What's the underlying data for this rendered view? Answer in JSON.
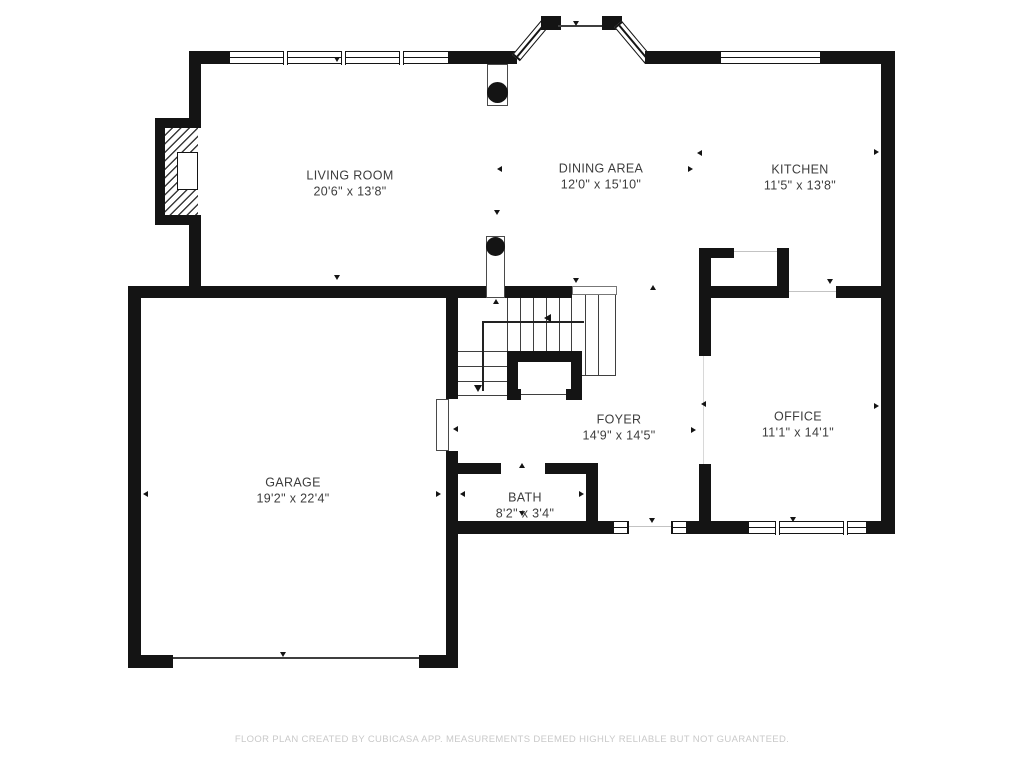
{
  "plan": {
    "rooms": [
      {
        "name": "LIVING ROOM",
        "dims": "20'6\" x 13'8\""
      },
      {
        "name": "DINING AREA",
        "dims": "12'0\" x 15'10\""
      },
      {
        "name": "KITCHEN",
        "dims": "11'5\" x 13'8\""
      },
      {
        "name": "FOYER",
        "dims": "14'9\" x 14'5\""
      },
      {
        "name": "OFFICE",
        "dims": "11'1\" x 14'1\""
      },
      {
        "name": "GARAGE",
        "dims": "19'2\" x 22'4\""
      },
      {
        "name": "BATH",
        "dims": "8'2\" x 3'4\""
      }
    ],
    "footer": "FLOOR PLAN CREATED BY CUBICASA APP. MEASUREMENTS DEEMED HIGHLY RELIABLE BUT NOT GUARANTEED."
  },
  "colors": {
    "wall": "#141414",
    "thin_line": "#3f3f3f",
    "light_line": "#c3c3c3",
    "label": "#3d3d3d",
    "footer_text": "#c9c9c9",
    "background": "#ffffff"
  },
  "icons": {
    "arrow-marker": "css-triangle",
    "column": "filled-circle-in-box",
    "fireplace": "diagonal-hatch-block"
  }
}
